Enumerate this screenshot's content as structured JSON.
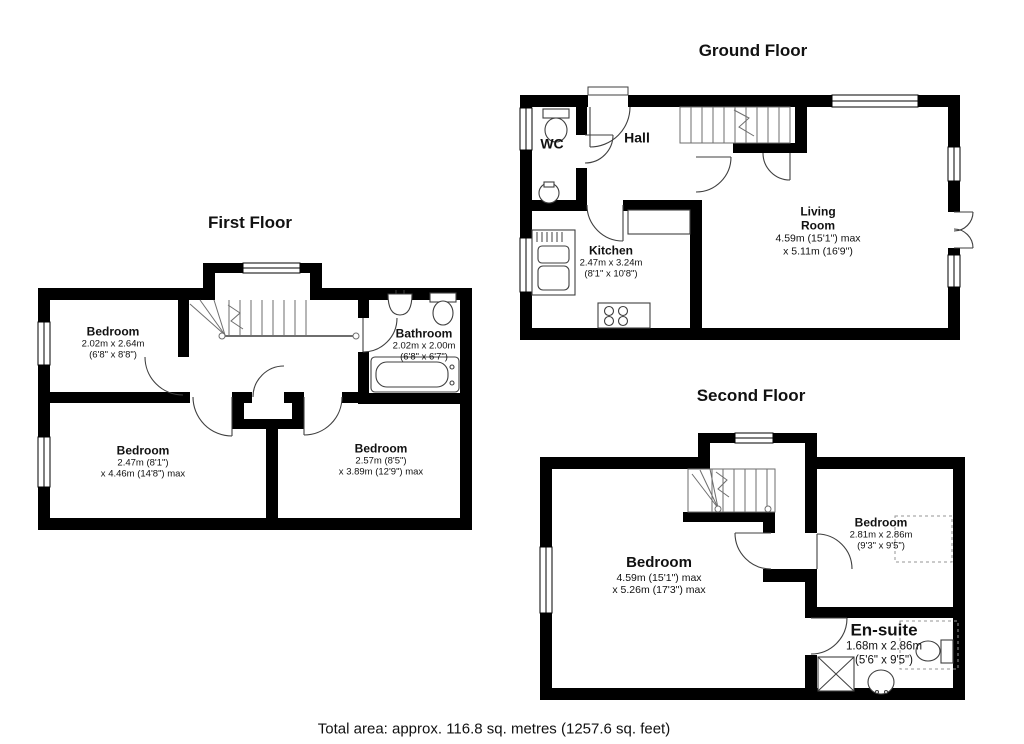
{
  "footer": {
    "total_area": "Total area: approx. 116.8 sq. metres (1257.6 sq. feet)"
  },
  "colors": {
    "wall": "#000000",
    "background": "#ffffff",
    "fixture_line": "#3f3f3f",
    "text": "#111111"
  },
  "floors": {
    "first": {
      "title": "First Floor",
      "rooms": {
        "bedroom_top": {
          "name": "Bedroom",
          "dims1": "2.02m x 2.64m",
          "dims2": "(6'8\" x 8'8\")"
        },
        "bathroom": {
          "name": "Bathroom",
          "dims1": "2.02m x 2.00m",
          "dims2": "(6'8\" x 6'7\")"
        },
        "bedroom_left": {
          "name": "Bedroom",
          "dims1": "2.47m (8'1\")",
          "dims2": "x 4.46m (14'8\") max"
        },
        "bedroom_right": {
          "name": "Bedroom",
          "dims1": "2.57m (8'5\")",
          "dims2": "x 3.89m (12'9\") max"
        }
      }
    },
    "ground": {
      "title": "Ground Floor",
      "rooms": {
        "wc": {
          "name": "WC"
        },
        "hall": {
          "name": "Hall"
        },
        "kitchen": {
          "name": "Kitchen",
          "dims1": "2.47m x 3.24m",
          "dims2": "(8'1\" x 10'8\")"
        },
        "living_room": {
          "name": "Living",
          "name2": "Room",
          "dims1": "4.59m (15'1\") max",
          "dims2": "x 5.11m (16'9\")"
        }
      }
    },
    "second": {
      "title": "Second Floor",
      "rooms": {
        "bedroom_main": {
          "name": "Bedroom",
          "dims1": "4.59m (15'1\") max",
          "dims2": "x 5.26m (17'3\") max"
        },
        "bedroom_small": {
          "name": "Bedroom",
          "dims1": "2.81m x 2.86m",
          "dims2": "(9'3\" x 9'5\")"
        },
        "ensuite": {
          "name": "En-suite",
          "dims1": "1.68m x 2.86m",
          "dims2": "(5'6\" x 9'5\")"
        }
      }
    }
  }
}
